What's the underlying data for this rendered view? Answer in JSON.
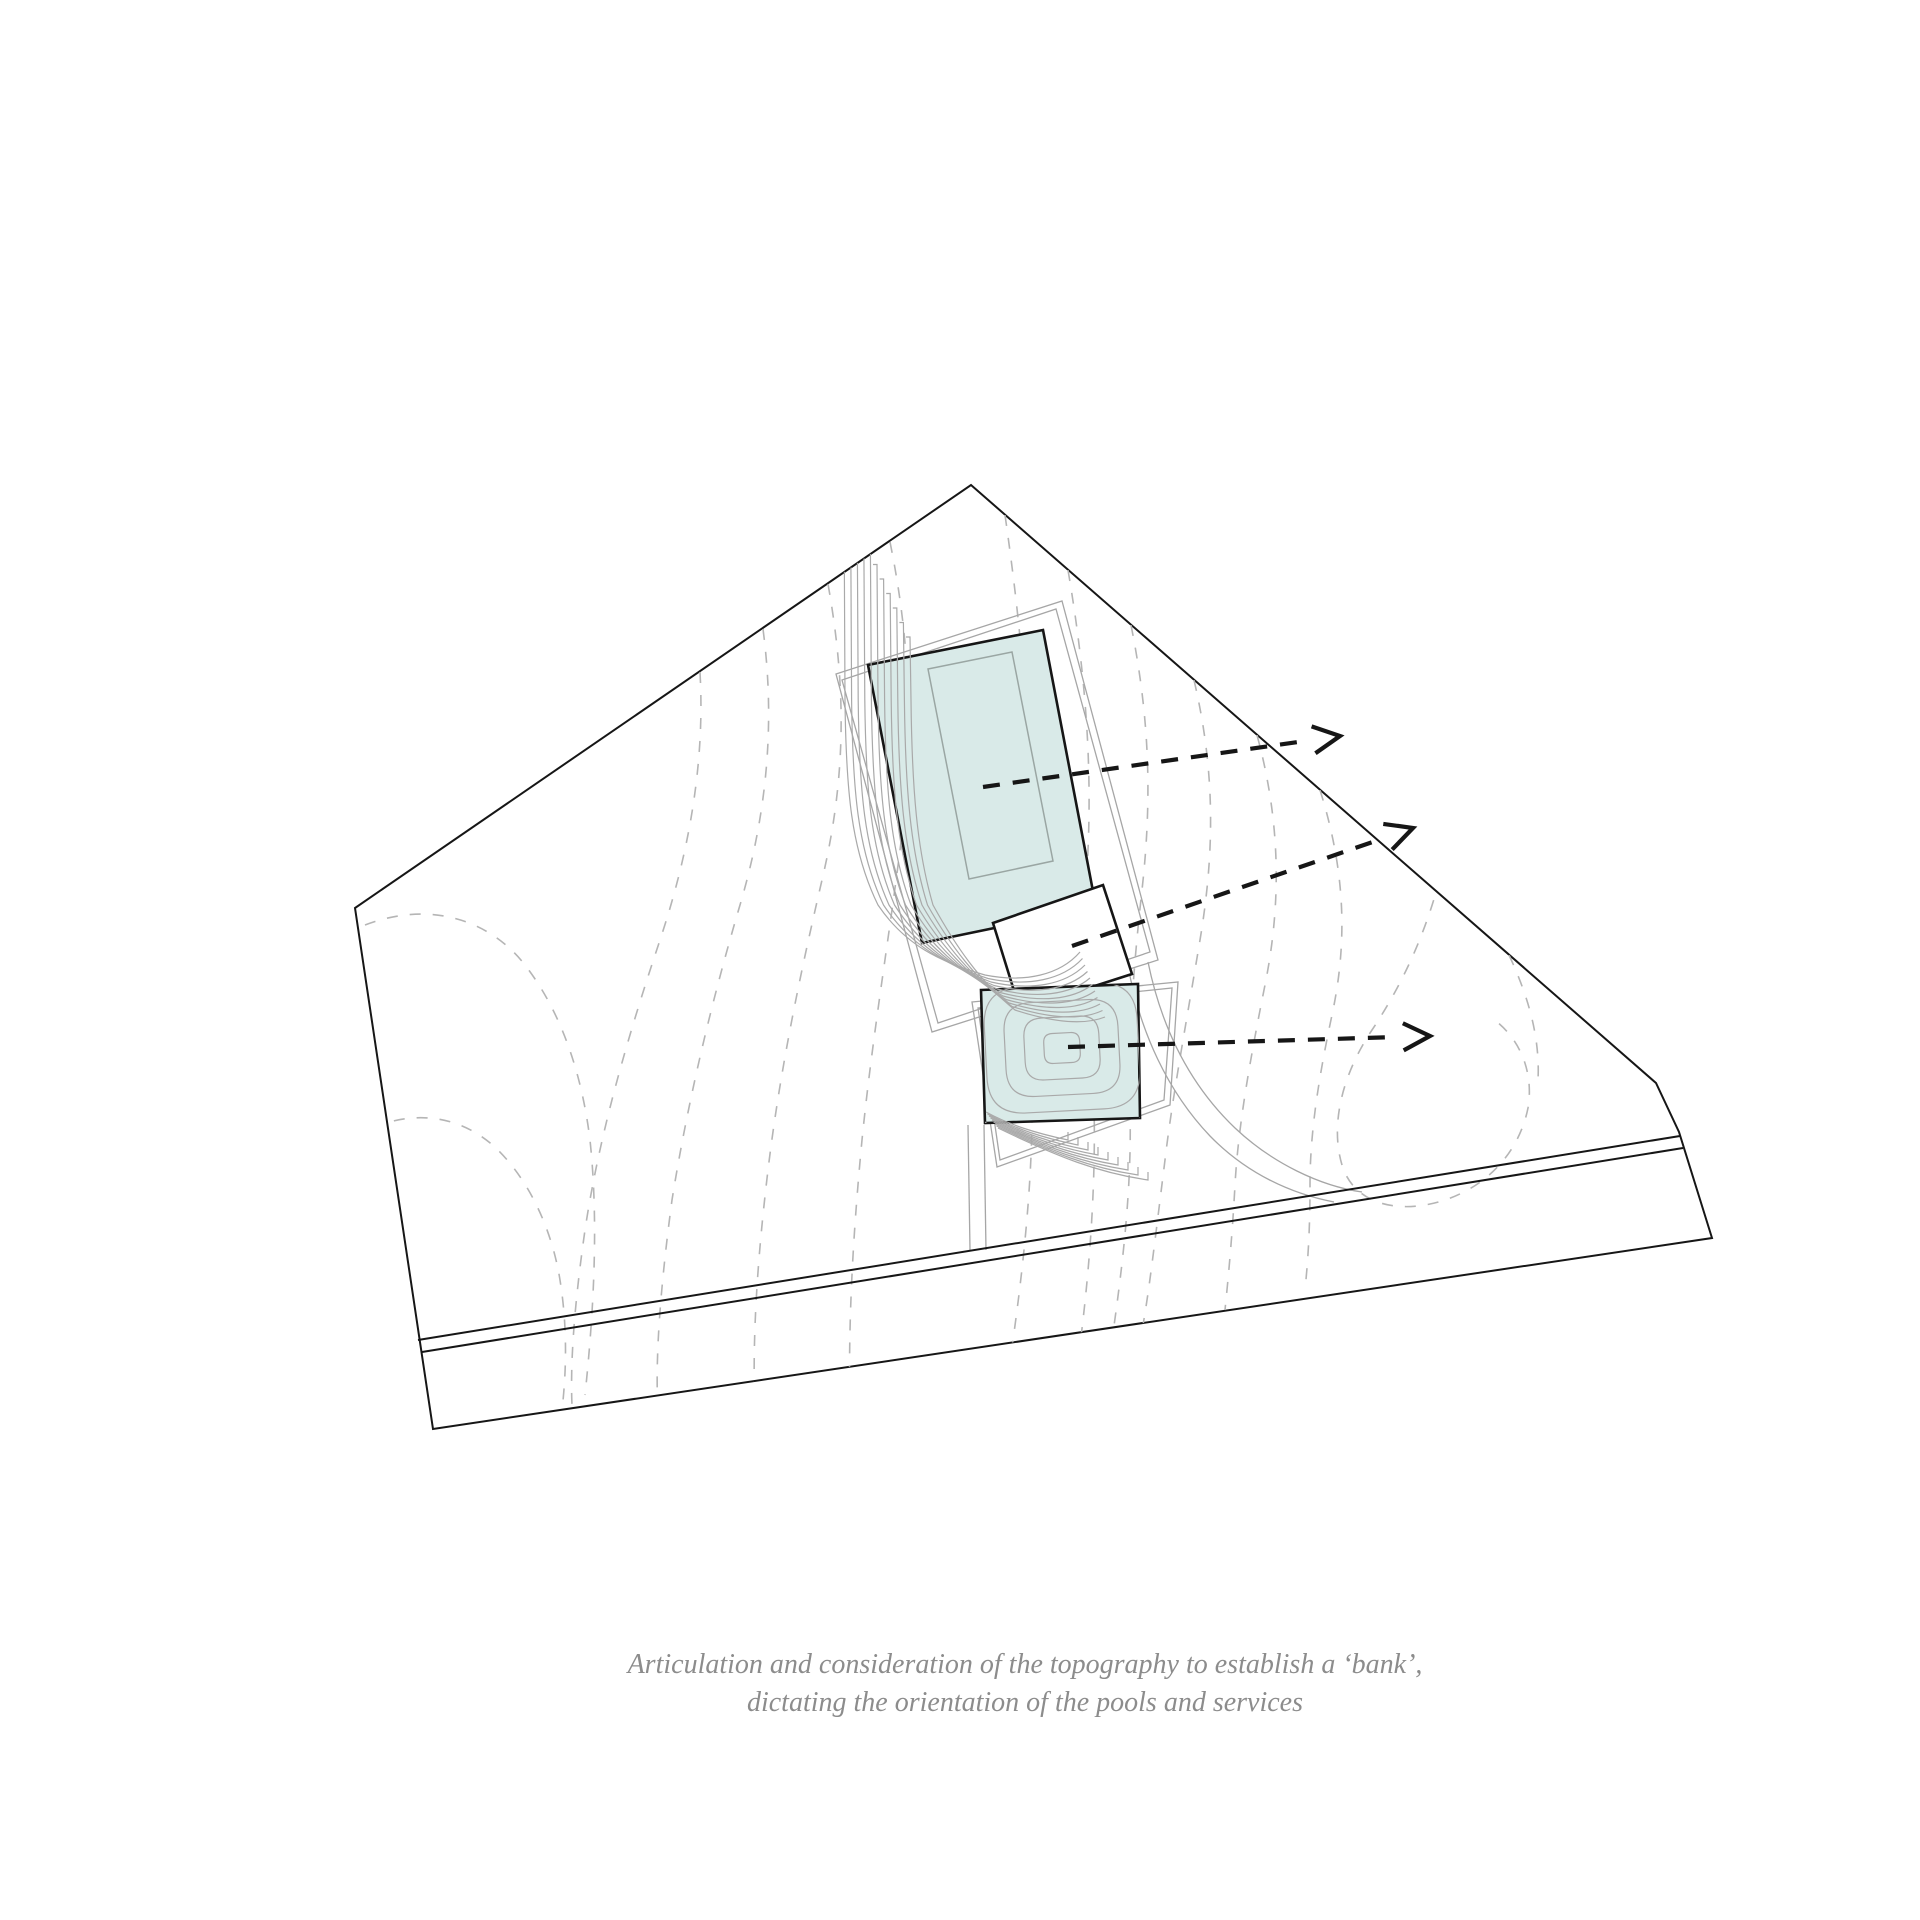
{
  "figure": {
    "type": "architectural-site-topography-diagram",
    "caption": {
      "line1": "Articulation and consideration of the topography to establish a ‘bank’,",
      "line2": "dictating the orientation of the pools and services"
    }
  },
  "colors": {
    "pool_fill": "#d9eae8",
    "ink": "#161616",
    "contour_gray": "#b5b5b5",
    "fine_gray": "#a9a9a9",
    "deck_gray": "#a6a6a6",
    "basin_gray": "#9aa6a3",
    "caption_gray": "#8c8c8c",
    "background": "#ffffff"
  },
  "site": {
    "boundary": [
      [
        971,
        485
      ],
      [
        1656,
        1083
      ],
      [
        1679,
        1132
      ],
      [
        1712,
        1238
      ],
      [
        433,
        1429
      ],
      [
        355,
        908
      ]
    ],
    "road_lines": [
      [
        [
          418,
          1340
        ],
        [
          1680,
          1136
        ]
      ],
      [
        [
          422,
          1352
        ],
        [
          1683,
          1148
        ]
      ]
    ]
  },
  "pools": {
    "upper_pool": [
      [
        868,
        665
      ],
      [
        1043,
        630
      ],
      [
        1096,
        907
      ],
      [
        922,
        943
      ]
    ],
    "upper_pool_basin": [
      [
        928,
        669
      ],
      [
        1012,
        652
      ],
      [
        1053,
        861
      ],
      [
        969,
        879
      ]
    ],
    "services_square": [
      [
        993,
        923
      ],
      [
        1103,
        885
      ],
      [
        1132,
        974
      ],
      [
        1020,
        1010
      ]
    ],
    "lower_pool": [
      [
        981,
        990
      ],
      [
        1138,
        984
      ],
      [
        1140,
        1118
      ],
      [
        985,
        1123
      ]
    ]
  },
  "generated": {
    "bank_terrace_line_count": 11,
    "lower_terrace_line_count": 9,
    "lower_pool_ring_count": 5,
    "ring_center": [
      1062,
      1048
    ]
  },
  "annotations": {
    "arrows": [
      {
        "name": "upper-pool-orientation-arrow",
        "from": [
          983,
          787
        ],
        "to": [
          1340,
          736
        ]
      },
      {
        "name": "services-orientation-arrow",
        "from": [
          1072,
          946
        ],
        "to": [
          1413,
          828
        ]
      },
      {
        "name": "lower-pool-orientation-arrow",
        "from": [
          1068,
          1047
        ],
        "to": [
          1430,
          1036
        ]
      }
    ]
  }
}
